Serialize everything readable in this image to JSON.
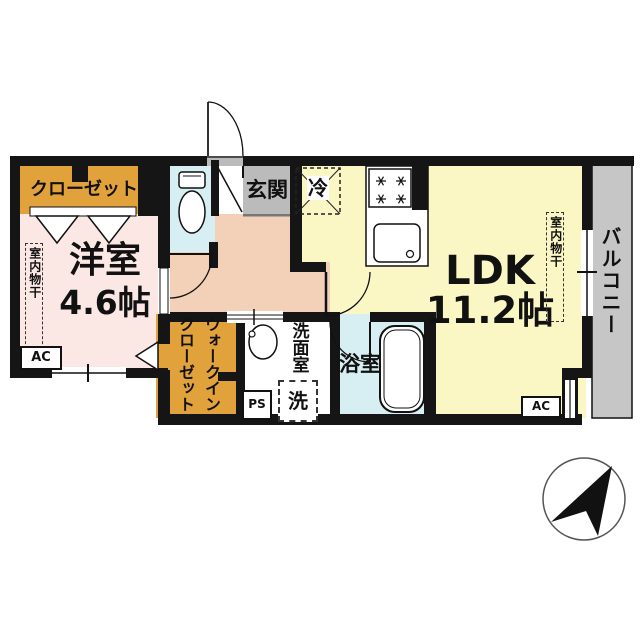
{
  "floorplan": {
    "closet_label": "クローゼット",
    "western_room": {
      "name": "洋室",
      "size": "4.6帖",
      "ac_label": "AC",
      "drying_label": "室内物干"
    },
    "entrance_label": "玄関",
    "refrigerator_label": "冷",
    "ldk": {
      "name": "LDK",
      "size": "11.2帖",
      "ac_label": "AC",
      "drying_label": "室内物干"
    },
    "balcony_label": "バルコニー",
    "walk_in_closet_label": "ウォークインクローゼット",
    "washroom_label": "洗面室",
    "washer_label": "洗",
    "pipe_space_label": "PS",
    "bathroom_label": "浴室"
  },
  "icons": {
    "compass": "north-east-compass-arrow",
    "fixtures": [
      "toilet",
      "bathtub",
      "washbasin",
      "kitchen-stove",
      "kitchen-sink",
      "entry-door",
      "room-doors",
      "folding-door-triangles"
    ]
  },
  "colors": {
    "c_wall": "#151515",
    "c_west": "#fbe8e5",
    "c_hall": "#f3d0b8",
    "c_ldk": "#fbf7c5",
    "c_orange": "#e2a23b",
    "c_blue": "#d7eef3",
    "c_genkan": "#bbbbbb",
    "c_balcony": "#c6c6c6",
    "c_line": "#111111",
    "c_text": "#111111"
  }
}
